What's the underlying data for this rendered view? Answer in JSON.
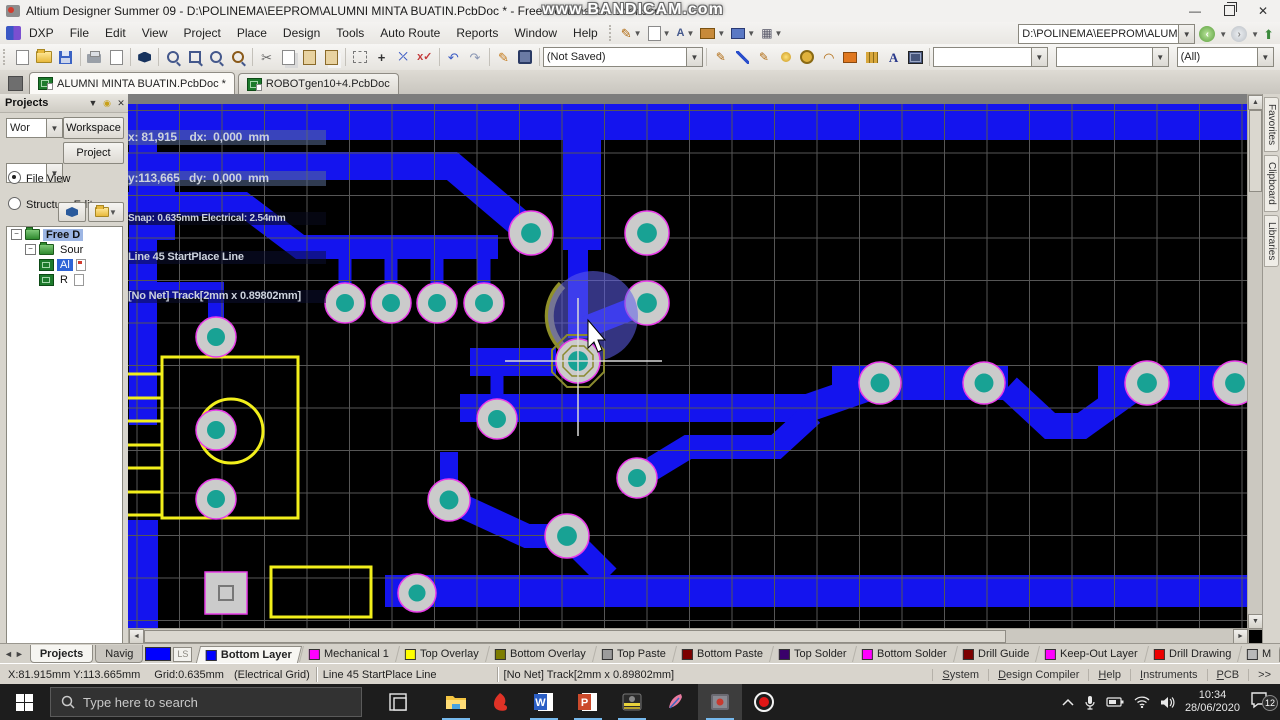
{
  "window": {
    "title": "Altium Designer Summer 09 - D:\\POLINEMA\\EEPROM\\ALUMNI MINTA BUATIN.PcbDoc * - Free Documents. Licensed",
    "watermark": "www.BANDICAM.com"
  },
  "menus": [
    "DXP",
    "File",
    "Edit",
    "View",
    "Project",
    "Place",
    "Design",
    "Tools",
    "Auto Route",
    "Reports",
    "Window",
    "Help"
  ],
  "nav": {
    "path": "D:\\POLINEMA\\EEPROM\\ALUMNI N"
  },
  "toolbar": {
    "doc_state": "(Not Saved)",
    "filter_all": "(All)"
  },
  "doc_tabs": [
    {
      "label": "ALUMNI MINTA BUATIN.PcbDoc *",
      "active": true
    },
    {
      "label": "ROBOTgen10+4.PcbDoc",
      "active": false
    }
  ],
  "projects": {
    "title": "Projects",
    "workspace_combo": "Wor",
    "workspace_btn": "Workspace",
    "project_btn": "Project",
    "radio1": "File View",
    "radio2": "Structure Editor",
    "tree": [
      {
        "label": "Free D",
        "icon": "folder",
        "indent": 0,
        "hl": "soft",
        "expand": true
      },
      {
        "label": "Sour",
        "icon": "folder",
        "indent": 1,
        "expand": true
      },
      {
        "label": "Al",
        "icon": "pcb",
        "indent": 2,
        "hl": "strong",
        "doc": "red"
      },
      {
        "label": "R",
        "icon": "pcb",
        "indent": 2,
        "doc": "plain"
      }
    ],
    "bottom_tabs": [
      {
        "label": "Projects",
        "active": true
      },
      {
        "label": "Navig",
        "active": false
      }
    ]
  },
  "hud": {
    "row1": "x: 81,915    dx:  0,000  mm",
    "row2": "y:113,665   dy:  0,000  mm",
    "row3": "Snap: 0.635mm Electrical: 2.54mm",
    "row4": "Line 45 StartPlace Line",
    "row5": "[No Net] Track[2mm x 0.89802mm]"
  },
  "layer_bar": {
    "ls": "LS",
    "tabs": [
      {
        "label": "Bottom Layer",
        "color": "#0000ff",
        "active": true
      },
      {
        "label": "Mechanical 1",
        "color": "#ff00ff"
      },
      {
        "label": "Top Overlay",
        "color": "#ffff00"
      },
      {
        "label": "Bottom Overlay",
        "color": "#7d7d00"
      },
      {
        "label": "Top Paste",
        "color": "#9c9c9c"
      },
      {
        "label": "Bottom Paste",
        "color": "#7d0000"
      },
      {
        "label": "Top Solder",
        "color": "#3a006b"
      },
      {
        "label": "Bottom Solder",
        "color": "#ff00ff"
      },
      {
        "label": "Drill Guide",
        "color": "#7d0000"
      },
      {
        "label": "Keep-Out Layer",
        "color": "#ff00ff"
      },
      {
        "label": "Drill Drawing",
        "color": "#ee0000"
      },
      {
        "label": "M",
        "color": "#b9b9b9"
      }
    ],
    "mask_level": "Mask Level",
    "clear": "Clear"
  },
  "status": {
    "position": "X:81.915mm Y:113.665mm",
    "grid": "Grid:0.635mm",
    "grid_mode": "(Electrical Grid)",
    "action": "Line 45 StartPlace Line",
    "track": "[No Net] Track[2mm x 0.89802mm]",
    "panels": [
      "System",
      "Design Compiler",
      "Help",
      "Instruments",
      "PCB",
      ">>"
    ]
  },
  "right_tabs": [
    "Favorites",
    "Clipboard",
    "Libraries"
  ],
  "taskbar": {
    "search_placeholder": "Type here to search",
    "time": "10:34",
    "date": "28/06/2020",
    "badge": "12",
    "word_letter": "W",
    "ppt_letter": "P"
  },
  "pcb": {
    "colors": {
      "bg": "#000000",
      "grid": "#565656",
      "trace": "#1414ee",
      "pad_body": "#cbcbcb",
      "pad_hole": "#18a294",
      "pad_ring": "#e83ce8",
      "silk": "#f2ef1b",
      "top_strip": "#7d7d7d"
    },
    "grid_spacing": 42.5,
    "traces": [
      {
        "d": "M128,122 H1247",
        "w": 36
      },
      {
        "d": "M582,104 V250",
        "w": 38
      },
      {
        "d": "M578,245 V338",
        "w": 20
      },
      {
        "d": "M586,327 L647,303",
        "w": 22
      },
      {
        "d": "M470,362 H556",
        "w": 28
      },
      {
        "d": "M497,417 V362",
        "w": 13
      },
      {
        "d": "M460,408 H808 L880,383",
        "w": 28
      },
      {
        "d": "M832,383 H1008",
        "w": 34
      },
      {
        "d": "M1008,387 L1050,426 H1082 L1142,383",
        "w": 26
      },
      {
        "d": "M1098,383 H1247",
        "w": 34
      },
      {
        "d": "M637,478 L688,447 L776,447 L812,414",
        "w": 24
      },
      {
        "d": "M143,104 V425",
        "w": 28
      },
      {
        "d": "M128,166 H452 L531,233",
        "w": 28
      },
      {
        "d": "M128,204 H243 L300,247 H498",
        "w": 24
      },
      {
        "d": "M165,166 V240",
        "w": 20
      },
      {
        "d": "M345,300 V252",
        "w": 13
      },
      {
        "d": "M391,300 V252",
        "w": 13
      },
      {
        "d": "M437,300 V252",
        "w": 13
      },
      {
        "d": "M484,300 V252",
        "w": 13
      },
      {
        "d": "M216,334 V290 H150",
        "w": 16
      },
      {
        "d": "M143,520 V628",
        "w": 30
      },
      {
        "d": "M449,498 V452",
        "w": 18
      },
      {
        "d": "M449,500 L527,536 H567",
        "w": 24
      },
      {
        "d": "M567,536 L608,577",
        "w": 24
      },
      {
        "d": "M385,591 H1247",
        "w": 32
      }
    ],
    "pads": [
      [
        531,
        233,
        22
      ],
      [
        647,
        233,
        22
      ],
      [
        345,
        303,
        20
      ],
      [
        391,
        303,
        20
      ],
      [
        437,
        303,
        20
      ],
      [
        484,
        303,
        20
      ],
      [
        647,
        303,
        22
      ],
      [
        216,
        337,
        20
      ],
      [
        216,
        430,
        20
      ],
      [
        216,
        499,
        20
      ],
      [
        497,
        419,
        20
      ],
      [
        449,
        500,
        21
      ],
      [
        567,
        536,
        22
      ],
      [
        637,
        478,
        20
      ],
      [
        880,
        383,
        21
      ],
      [
        984,
        383,
        21
      ],
      [
        1147,
        383,
        22
      ],
      [
        1235,
        383,
        22
      ],
      [
        417,
        593,
        19
      ]
    ],
    "selected_pad": [
      578,
      361,
      22
    ],
    "square_pad": [
      205,
      572,
      42
    ],
    "silk": {
      "rect1": [
        162,
        357,
        136,
        161
      ],
      "circle": [
        231,
        431,
        32
      ],
      "rect2": [
        271,
        567,
        100,
        50
      ],
      "pin_ys": [
        374,
        398,
        421,
        445,
        468,
        492,
        515
      ]
    }
  }
}
